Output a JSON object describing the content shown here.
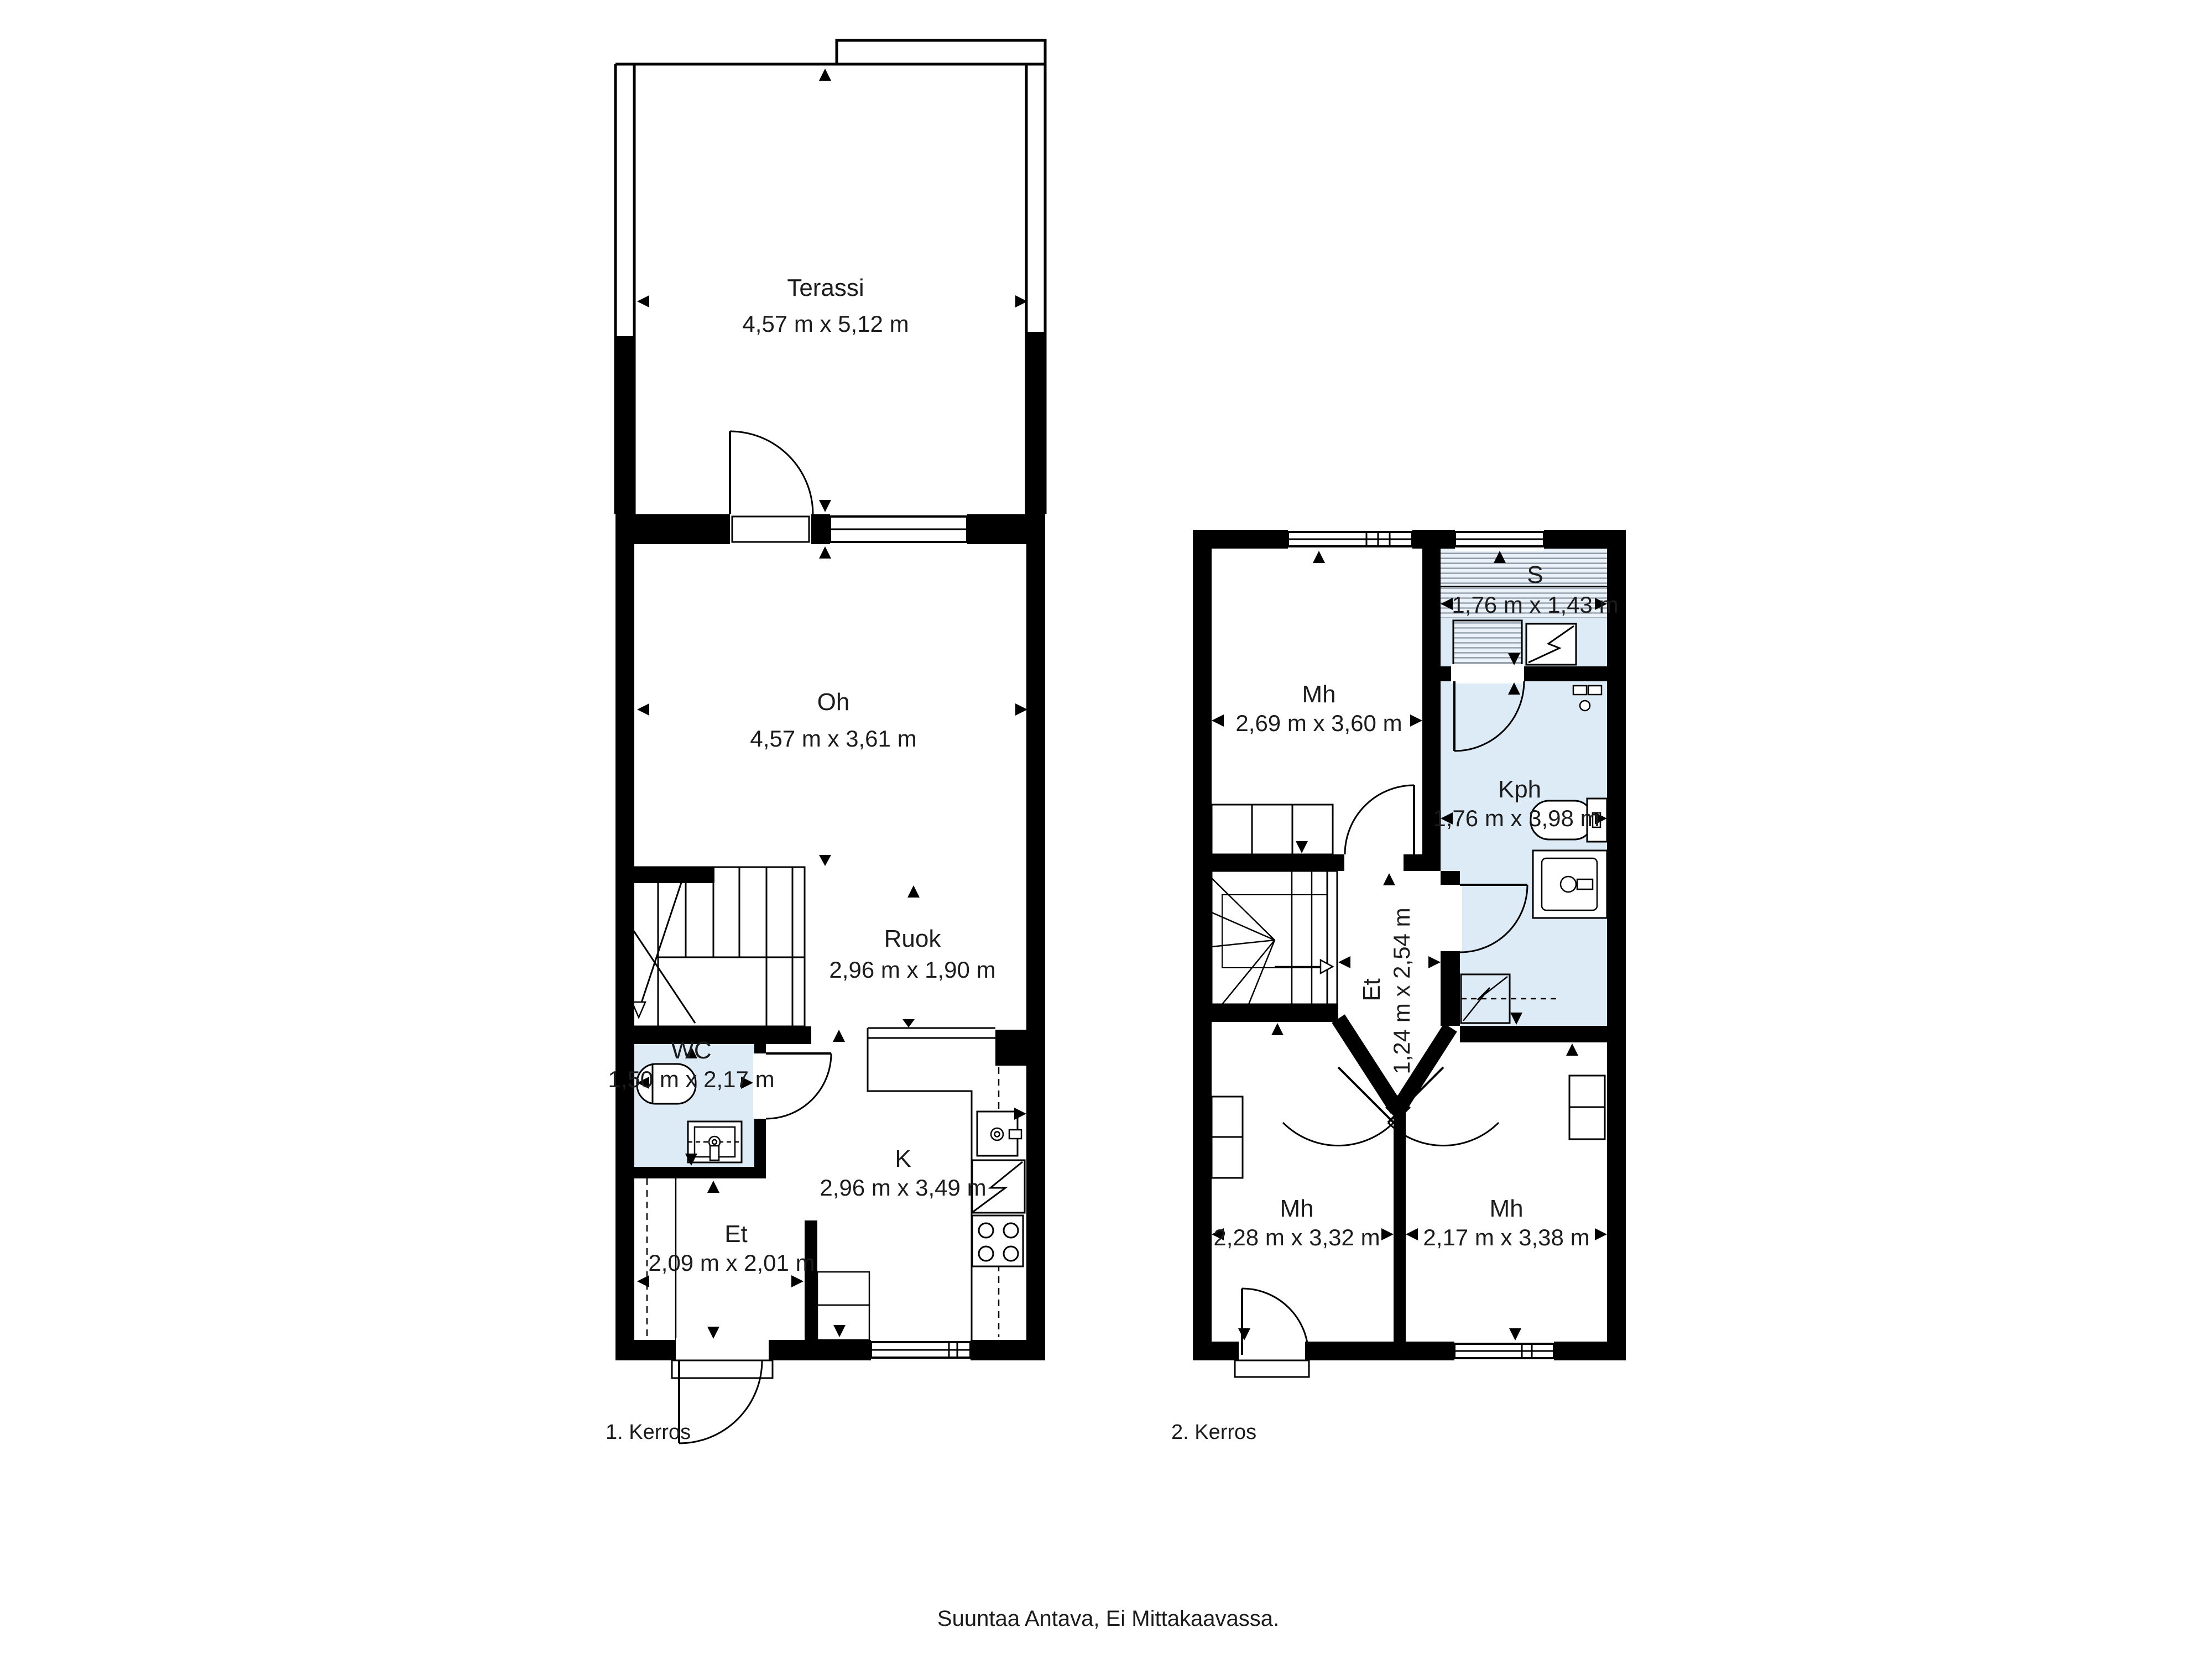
{
  "document_type": "floor-plan",
  "floors": [
    {
      "label": "1. Kerros",
      "rooms": [
        {
          "id": "terassi",
          "name": "Terassi",
          "dims": "4,57 m x 5,12 m"
        },
        {
          "id": "oh",
          "name": "Oh",
          "dims": "4,57 m x 3,61 m"
        },
        {
          "id": "ruok",
          "name": "Ruok",
          "dims": "2,96 m x 1,90 m"
        },
        {
          "id": "wc",
          "name": "WC",
          "dims": "1,50 m x 2,17 m"
        },
        {
          "id": "et",
          "name": "Et",
          "dims": "2,09 m x 2,01 m"
        },
        {
          "id": "k",
          "name": "K",
          "dims": "2,96 m x 3,49 m"
        }
      ]
    },
    {
      "label": "2. Kerros",
      "rooms": [
        {
          "id": "mh-nw",
          "name": "Mh",
          "dims": "2,69 m x 3,60 m"
        },
        {
          "id": "s",
          "name": "S",
          "dims": "1,76 m x 1,43 m"
        },
        {
          "id": "kph",
          "name": "Kph",
          "dims": "1,76 m x 3,98 m"
        },
        {
          "id": "et2",
          "name": "Et",
          "dims": "1,24 m x 2,54 m"
        },
        {
          "id": "mh-sw",
          "name": "Mh",
          "dims": "2,28 m x 3,32 m"
        },
        {
          "id": "mh-se",
          "name": "Mh",
          "dims": "2,17 m x 3,38 m"
        }
      ]
    }
  ],
  "footer": {
    "note": "Suuntaa Antava, Ei Mittakaavassa."
  },
  "colors": {
    "wall": "#000000",
    "wet_room_fill": "#dcebf6",
    "hatch_base": "#eaf1f8",
    "hatch_line": "#7a8794",
    "text": "#1c1c1c",
    "background": "#ffffff"
  }
}
